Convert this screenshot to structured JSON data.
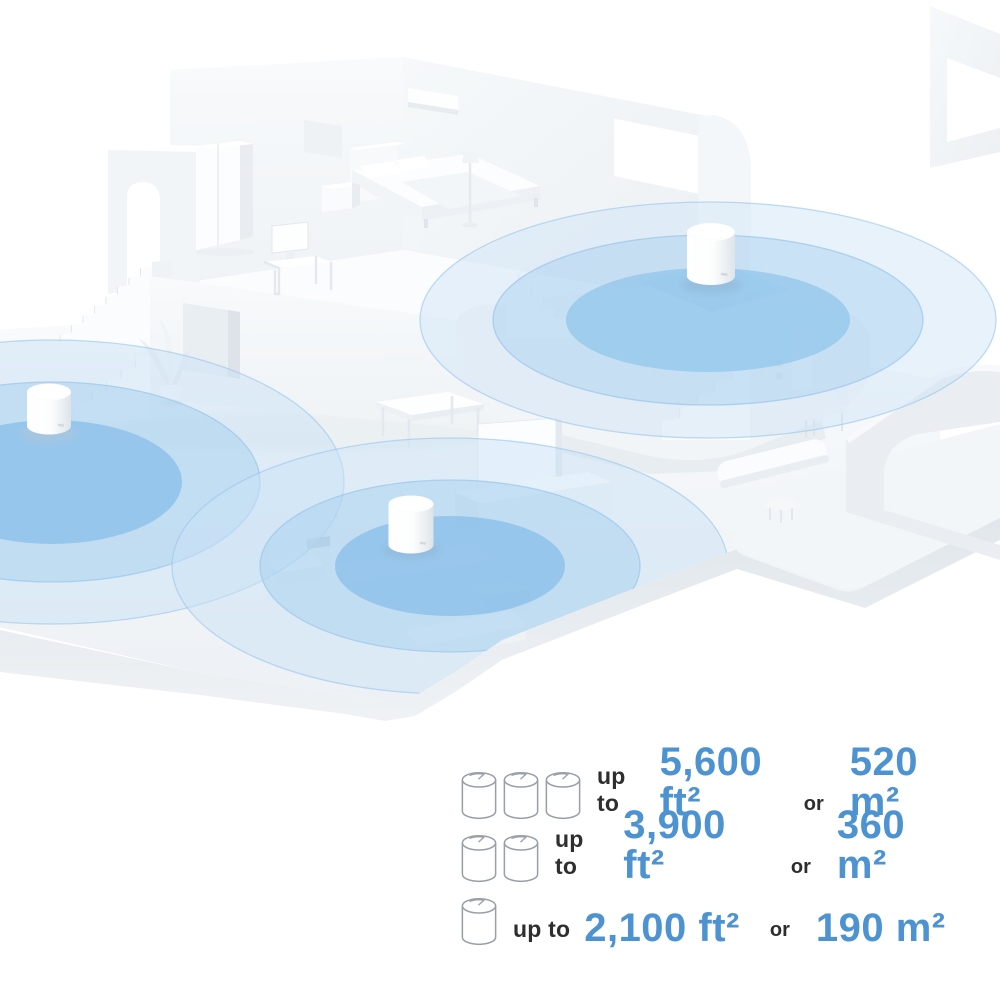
{
  "page": {
    "background": "#ffffff"
  },
  "colors": {
    "accent_blue_text": "#4e93d1",
    "dark_text": "#2e2e2e",
    "coverage_inner": "#86bde9",
    "coverage_mid": "#a6cfee",
    "coverage_outer": "#c9e1f5",
    "coverage_ring": "#9cc7eb",
    "floor_top": "#f0f3f6",
    "floor_side": "#e3e8ed",
    "wall": "#f5f7f9",
    "router_body": "#ffffff"
  },
  "scene": {
    "illustration": "isometric-house-mesh-wifi-coverage",
    "routers": [
      {
        "name": "deco-router-left-room"
      },
      {
        "name": "deco-router-upper-landing"
      },
      {
        "name": "deco-router-living-room"
      }
    ],
    "coverage_zones": [
      {
        "name": "coverage-zone-left"
      },
      {
        "name": "coverage-zone-upper"
      },
      {
        "name": "coverage-zone-living"
      }
    ]
  },
  "legend": {
    "rows": [
      {
        "units": 3,
        "prefix": "up to",
        "area_imperial": "5,600 ft²",
        "conjunction": "or",
        "area_metric": "520 m²"
      },
      {
        "units": 2,
        "prefix": "up to",
        "area_imperial": "3,900 ft²",
        "conjunction": "or",
        "area_metric": "360 m²"
      },
      {
        "units": 1,
        "prefix": "up to",
        "area_imperial": "2,100 ft²",
        "conjunction": "or",
        "area_metric": "190 m²"
      }
    ]
  }
}
